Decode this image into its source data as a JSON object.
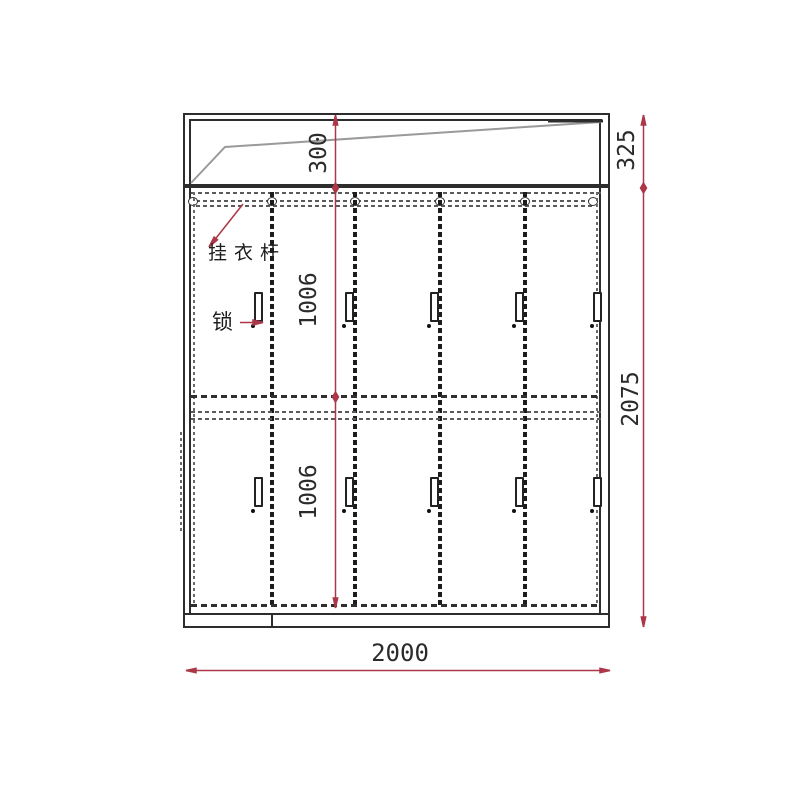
{
  "drawing": {
    "type": "wardrobe-elevation",
    "labels": {
      "hanging_rod": "挂衣杆",
      "lock": "锁"
    },
    "dimensions": {
      "top_section_height": "300",
      "upper_door_height": "1006",
      "lower_door_height": "1006",
      "top_unit_height": "325",
      "total_height": "2075",
      "total_width": "2000"
    },
    "structure": {
      "door_columns": 5,
      "door_rows": 2
    },
    "colors": {
      "dimension_line": "#ab3748",
      "outline": "#2d2d2d",
      "diagonal_line": "#9a9a9a"
    }
  }
}
